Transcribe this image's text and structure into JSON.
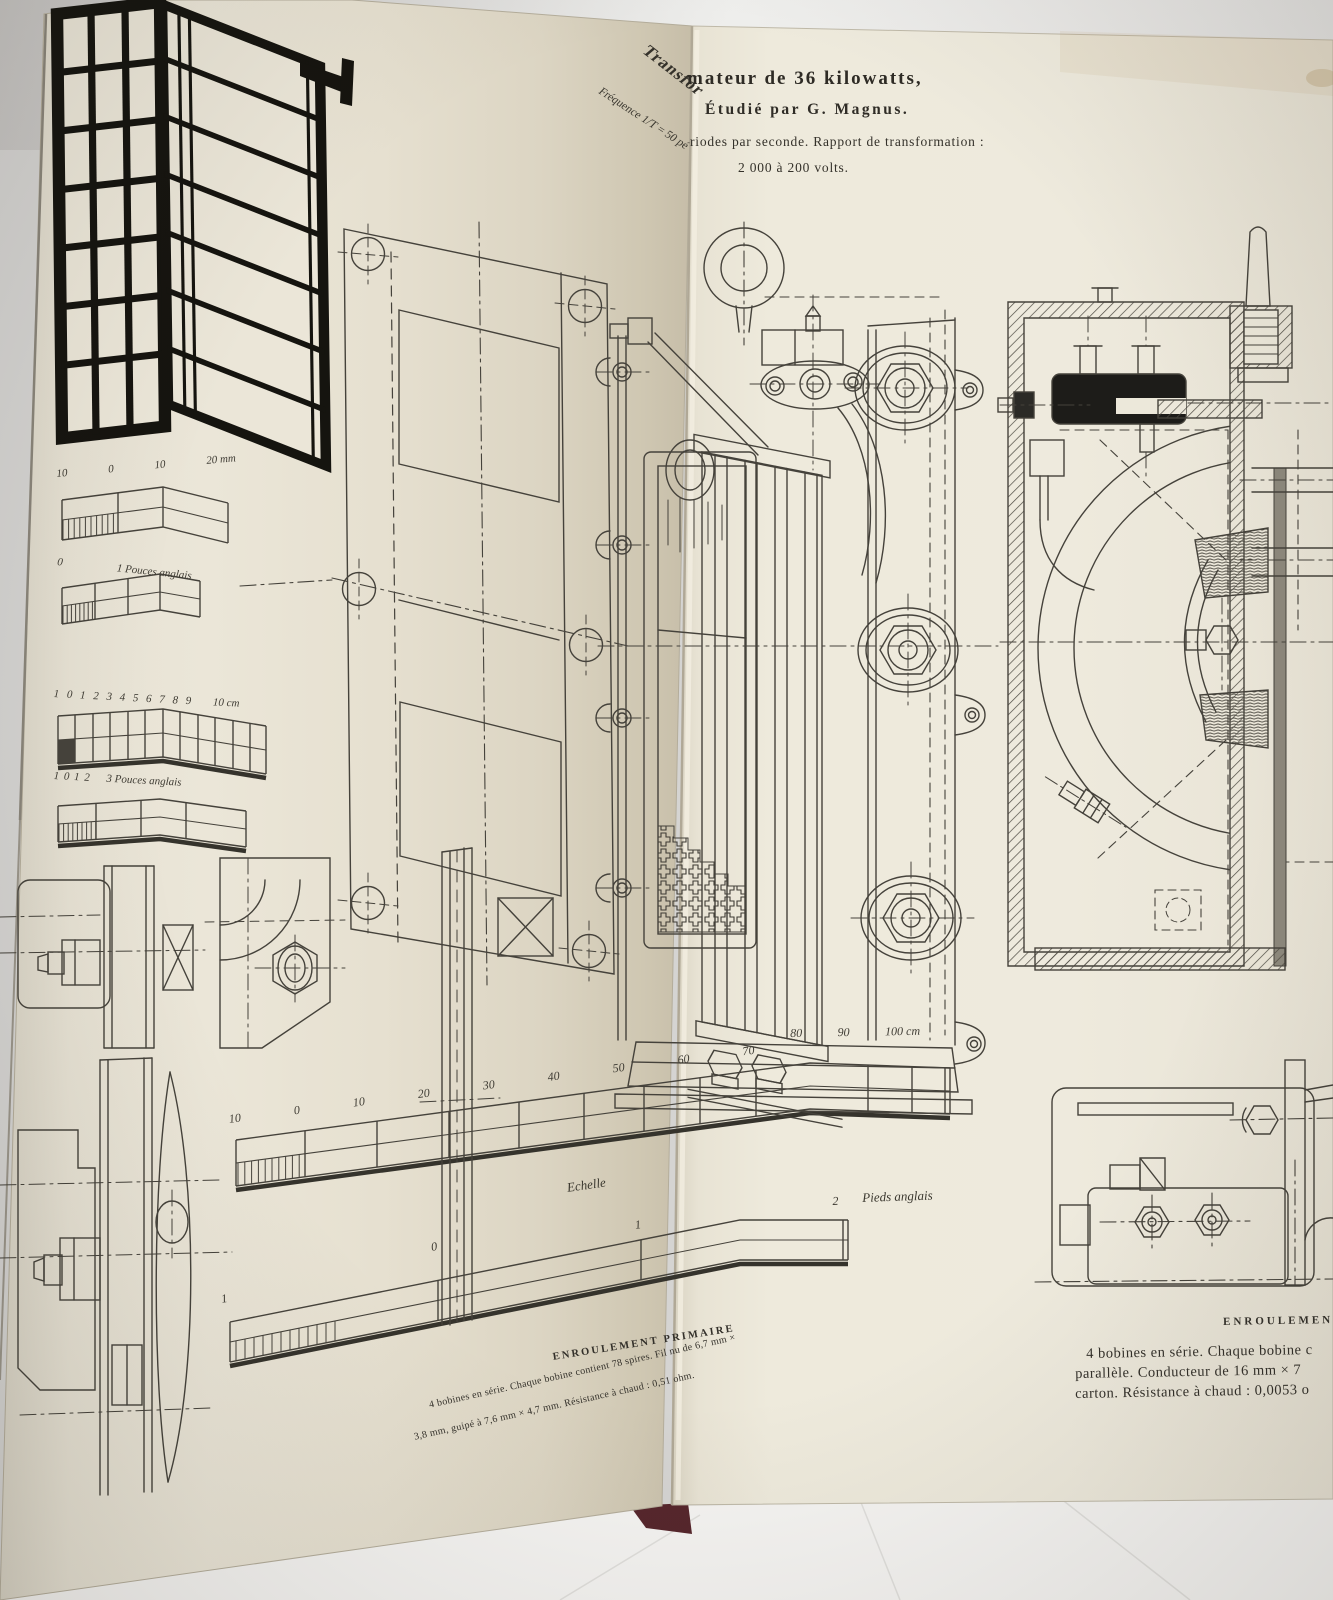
{
  "photo": {
    "background": "#d5d4d2",
    "table": "#f5f4f2",
    "page_left": "#e7e2d4",
    "page_right": "#ece8da",
    "ink": "#45423b",
    "ink_black": "#1b1a17",
    "cover_edge": "#56262c"
  },
  "header": {
    "title_fold_fragment": "Transfor",
    "title_main": "mateur de 36 kilowatts,",
    "byline": "Étudié par G. Magnus.",
    "freq_fold_fragment": "Fréquence 1/T = 50 pé",
    "line_periods": "riodes par seconde. Rapport de transformation :",
    "line_ratio": "2 000 à 200 volts."
  },
  "scales": {
    "mm": {
      "labels": [
        "10",
        "0",
        "10"
      ],
      "end": "20 mm"
    },
    "inch1": {
      "labels": [
        "0"
      ],
      "end": "1 Pouces anglais"
    },
    "cm10": {
      "labels": [
        "1",
        "0",
        "1",
        "2",
        "3",
        "4",
        "5",
        "6",
        "7",
        "8",
        "9"
      ],
      "end": "10 cm"
    },
    "inch3": {
      "labels": [
        "1",
        "0",
        "1",
        "2"
      ],
      "end": "3 Pouces anglais"
    },
    "cm100_left": {
      "labels": [
        "10",
        "0",
        "10",
        "20",
        "30",
        "40",
        "50",
        "60",
        "70"
      ]
    },
    "cm100_right": {
      "labels": [
        "80",
        "90"
      ],
      "end": "100 cm"
    },
    "caption": "Echelle",
    "feet": {
      "labels": [
        "1",
        "0",
        "1"
      ],
      "value": "2",
      "unit": "Pieds anglais"
    }
  },
  "notes": {
    "primary": {
      "heading": "ENROULEMENT PRIMAIRE",
      "line1": "4 bobines en série. Chaque bobine contient 78 spires. Fil nu de 6,7 mm ×",
      "line2": "3,8 mm, guipé à 7,6 mm × 4,7 mm. Résistance à chaud : 0,51 ohm."
    },
    "secondary": {
      "heading": "ENROULEMENT",
      "line1": "4 bobines en série. Chaque bobine c",
      "line2": "parallèle. Conducteur de 16 mm × 7",
      "line3": "carton. Résistance à chaud : 0,0053 o"
    }
  }
}
